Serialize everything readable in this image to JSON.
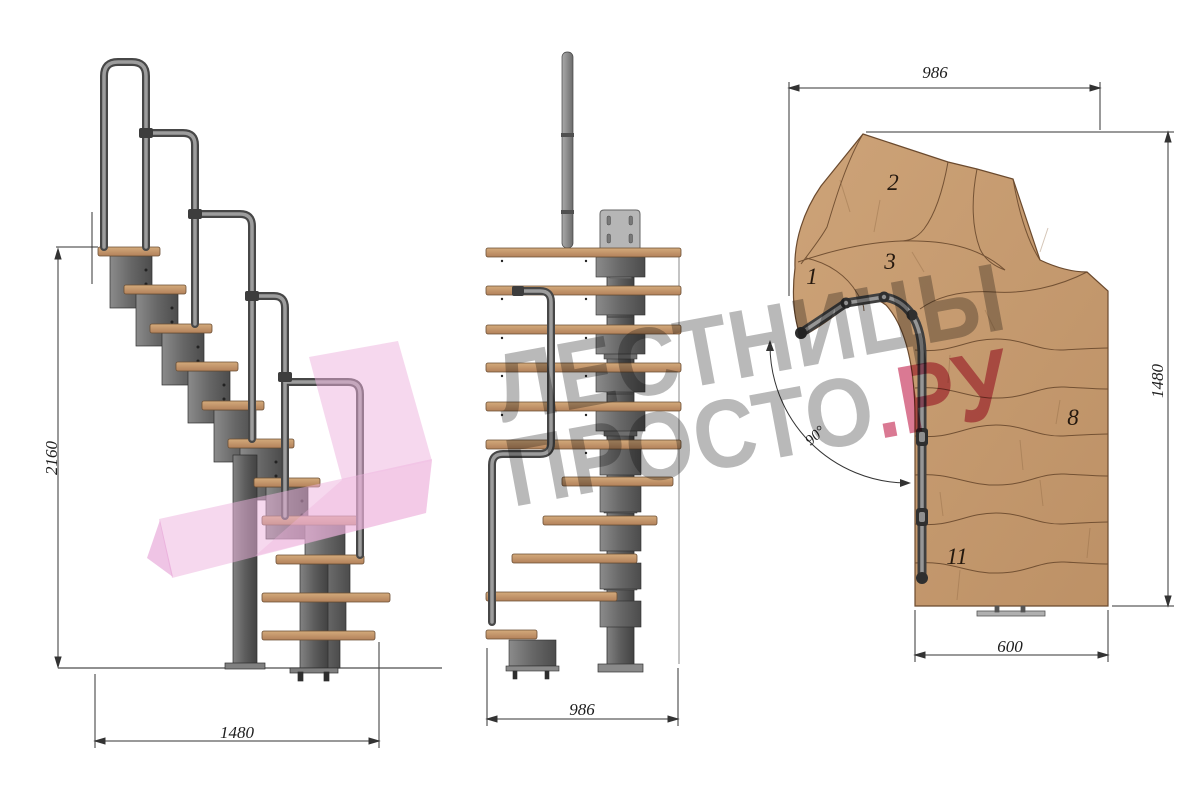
{
  "drawing": {
    "side_view": {
      "height_dim": "2160",
      "width_dim": "1480"
    },
    "front_view": {
      "width_dim": "986"
    },
    "plan_view": {
      "top_dim": "986",
      "right_dim": "1480",
      "bottom_dim": "600",
      "angle_dim": "90°",
      "treads": [
        {
          "label": "1"
        },
        {
          "label": "2"
        },
        {
          "label": "3"
        },
        {
          "label": "8"
        },
        {
          "label": "11"
        }
      ]
    },
    "watermark": {
      "line1": "ЛЕСТНИЦЫ",
      "line2_main": "ПРОСТО",
      "line2_accent": ".РУ"
    },
    "colors": {
      "wood": "#c79d72",
      "wood_edge": "#6b4a2e",
      "metal": "#6e6e6e",
      "metal_dark": "#3f3f3f",
      "handrail": "#8a8a8a",
      "mounting_plate": "#b6b6b6",
      "dimension_line": "#333333",
      "watermark_gray": "#6c6c6c",
      "watermark_red": "#c32650",
      "logo_pink": "#eeb2dd"
    }
  }
}
